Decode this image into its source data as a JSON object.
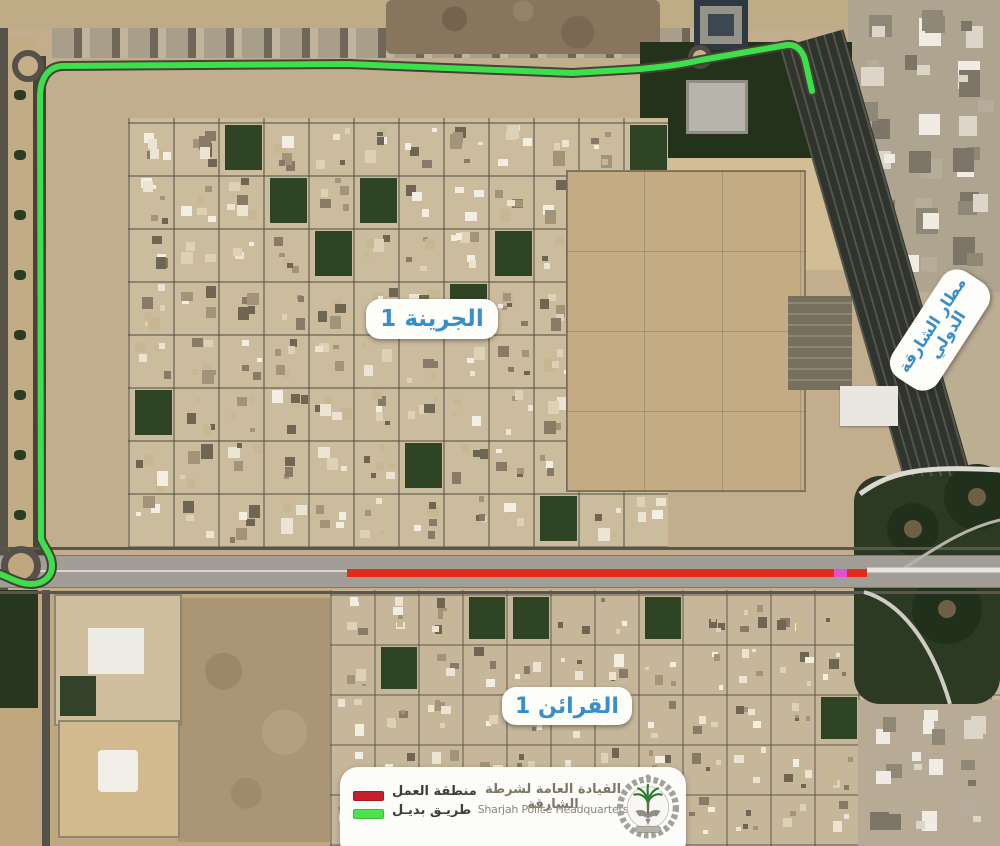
{
  "labels": {
    "district_north": "الجرينة 1",
    "district_south": "القرائن 1",
    "airport_line1": "مطار الشارقة",
    "airport_line2": "الدولي"
  },
  "legend": {
    "items": [
      {
        "key": "work-zone",
        "label": "منطقة العمل",
        "color": "#c52030"
      },
      {
        "key": "alt-route",
        "label": "طريـق بديـل",
        "color": "#4ce24c"
      }
    ],
    "org_ar": "القيادة العامة لشرطة الشارقة",
    "org_en": "Sharjah Police Headquarters"
  },
  "colors": {
    "work_zone_line": "#e22b1d",
    "alt_route_line": "#3ddf4a",
    "marker": "#e14fd2",
    "label_text": "#3a8fca"
  }
}
